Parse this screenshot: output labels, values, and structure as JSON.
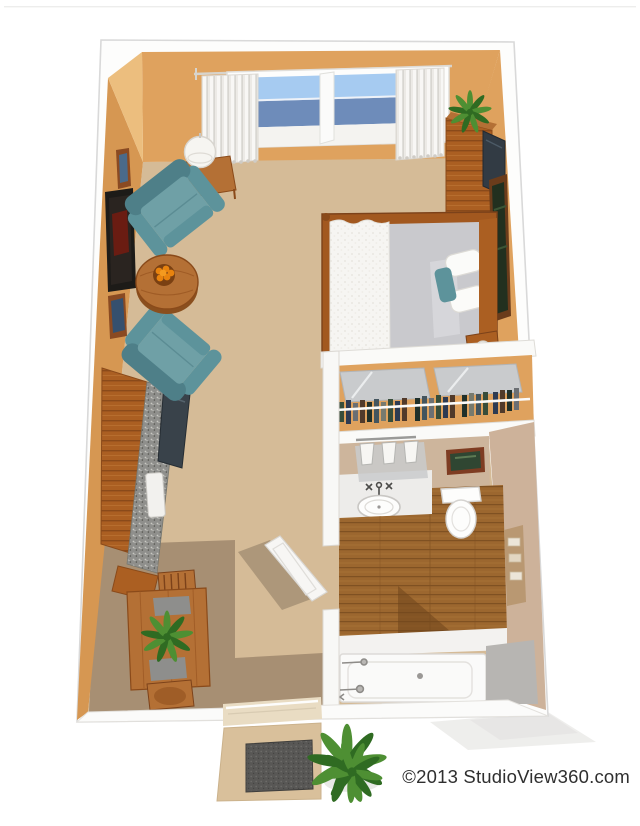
{
  "footer": {
    "copyright": "©2013 StudioView360.com"
  },
  "palette": {
    "page-bg": "#ffffff",
    "outline": "#d9d9d9",
    "wall": "#dfa25e",
    "wall-dark": "#d69752",
    "wall-light": "#ecbe7e",
    "wall-taupe": "#cdb29a",
    "vanity-wall": "#cdb59c",
    "carpet": "#d5bb97",
    "floor-dark": "#a78f73",
    "wood": "#ab5f22",
    "wood-light": "#b47035",
    "wood-dark": "#8a4a1a",
    "bath-wood": "#9c672f",
    "bath-wood-dark": "#855426",
    "teal": "#6fa0a6",
    "teal-mid": "#5d939b",
    "teal-dark": "#4e7f88",
    "white-soft": "#f7f6f4",
    "gray-soft": "#e9e8e6",
    "glass-top": "#a6cbf1",
    "glass-low": "#6e8cba",
    "curtain": "#efeeea",
    "counter": "#8f8f8c",
    "mirror": "#c9cbcd",
    "sheet": "#c9c9cd",
    "tile": "#b7b5b2",
    "mat": "#585755",
    "plant": "#4e8f33",
    "plant-dark": "#2f6b22",
    "orange": "#e8830e",
    "frame-brown": "#8a4a22",
    "frame-dark": "#1d1b18",
    "text": "#2f2f2f"
  },
  "scene": {
    "type": "3d-studio-apartment-floor-plan",
    "rooms": [
      "living-area",
      "sleeping-area",
      "closet",
      "bathroom",
      "kitchenette",
      "dining-nook",
      "entry"
    ],
    "objects": [
      "window",
      "curtains",
      "table-lamp",
      "armchair",
      "armchair",
      "round-coffee-table",
      "fruit-bowl",
      "wall-art",
      "bed",
      "nightstand",
      "media-center",
      "tv",
      "potted-plant",
      "closet-mirror-doors",
      "hanging-clothes",
      "vanity-lights",
      "vanity-sink",
      "toilet",
      "bathtub",
      "shelf-niche",
      "kitchen-cabinets",
      "kitchen-counter",
      "kitchen-sink",
      "appliance",
      "dining-table",
      "dining-chairs",
      "bathroom-door",
      "entry-doorway",
      "stoop",
      "doormat",
      "outdoor-plant"
    ]
  }
}
